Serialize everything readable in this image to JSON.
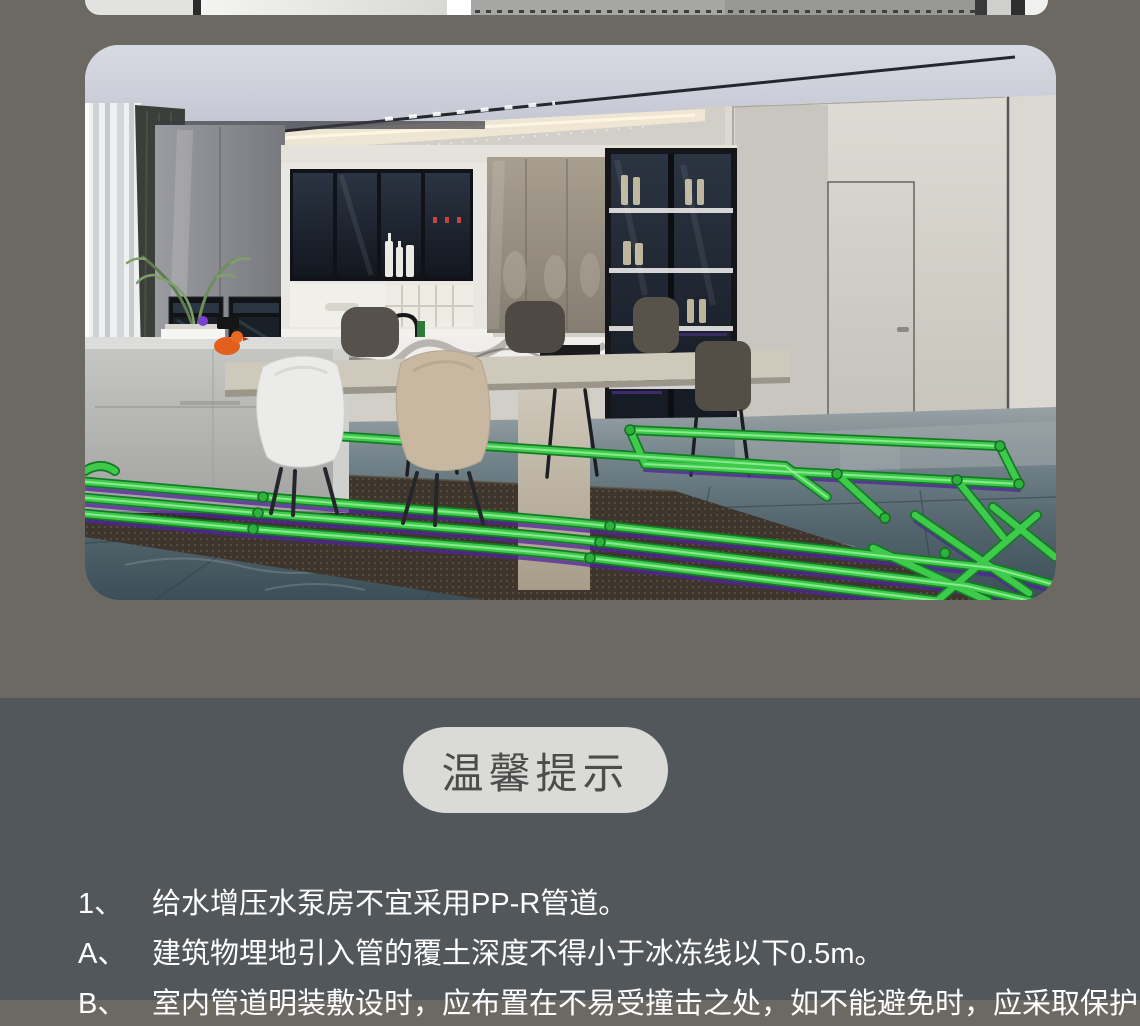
{
  "page": {
    "background_top": "#6C6962",
    "background_bottom": "#52575B"
  },
  "hero_image": {
    "label": "kitchen-interior-render-with-green-ppr-pipe-layout-on-floor",
    "pipe_color": "#3ECB4B",
    "pipe_shadow_color": "#51239B"
  },
  "tips": {
    "title": "温馨提示",
    "title_background": "#DADBD7",
    "title_color": "#4C4C4C",
    "text_color": "#FFFFFF",
    "items": [
      {
        "marker": "1、",
        "text": "给水增压水泵房不宜采用PP-R管道。"
      },
      {
        "marker": "A、",
        "text": "建筑物埋地引入管的覆土深度不得小于冰冻线以下0.5m。"
      },
      {
        "marker": "B、",
        "text": "室内管道明装敷设时，应布置在不易受撞击之处，如不能避免时，应采取保护"
      }
    ]
  }
}
